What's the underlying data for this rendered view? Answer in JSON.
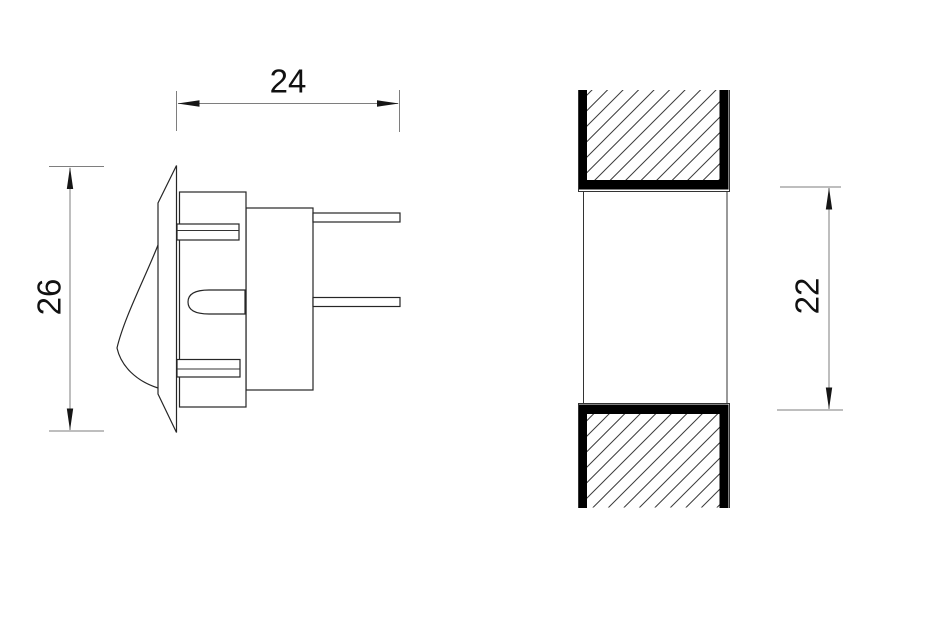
{
  "drawing": {
    "dimensions": {
      "width_label": "24",
      "height_label": "26",
      "cutout_label": "22"
    },
    "colors": {
      "background": "#ffffff",
      "outline": "#262626",
      "dimension_line": "#7e7e7e",
      "arrow": "#161616",
      "hatch_line": "#3c3c3c",
      "section_bar": "#000000",
      "text": "#111111"
    }
  }
}
